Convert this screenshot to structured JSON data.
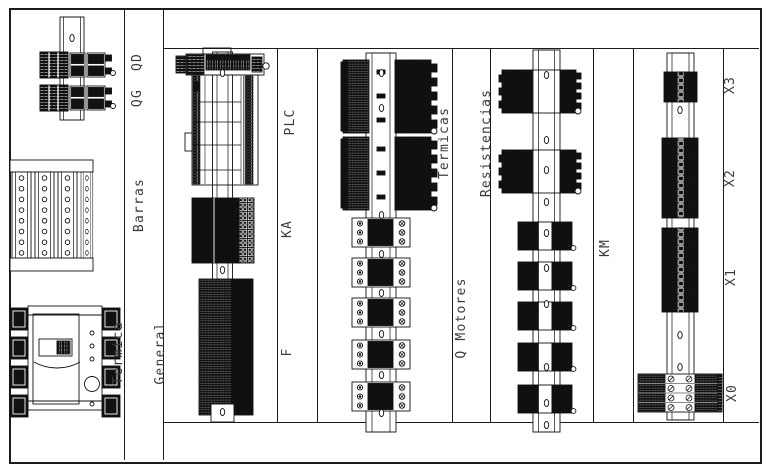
{
  "labels": {
    "left": {
      "qg_qd": "QG  QD",
      "barras": "Barras",
      "termica": [
        "Termica",
        "General"
      ]
    },
    "col1": {
      "plc": "PLC",
      "ka": "KA",
      "f": "F"
    },
    "col2": {
      "termicas": [
        "Termicas",
        "Resistencias"
      ],
      "q_motores": "Q Motores"
    },
    "col3": {
      "km": "KM"
    },
    "col4": {
      "x3": "X3",
      "x2": "X2",
      "x1": "X1",
      "x0": "X0"
    }
  },
  "colors": {
    "line": "#1a1a1a",
    "text": "#3b3b3b",
    "background": "#ffffff"
  }
}
